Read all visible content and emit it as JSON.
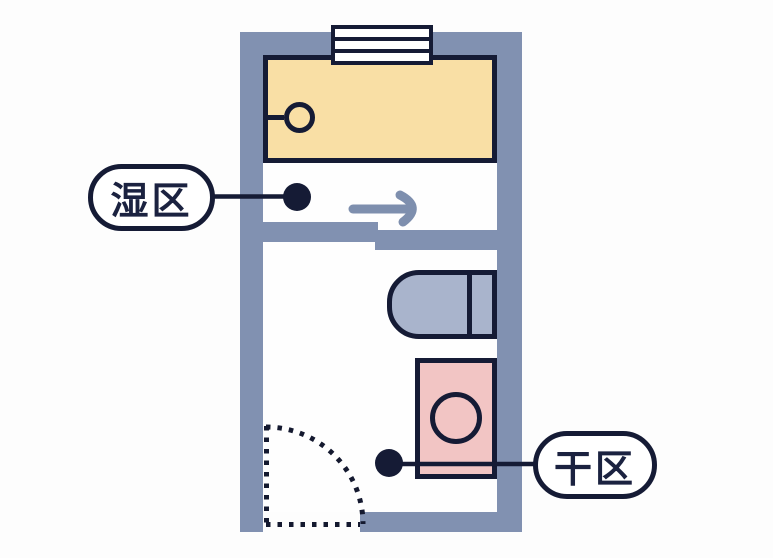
{
  "zones": [
    {
      "id": "wet-zone",
      "label": "湿区"
    },
    {
      "id": "dry-zone",
      "label": "干区"
    }
  ],
  "fixtures": [
    {
      "name": "window",
      "stripes": 3
    },
    {
      "name": "bathtub"
    },
    {
      "name": "faucet"
    },
    {
      "name": "flow-arrow",
      "direction": "right"
    },
    {
      "name": "partition-wall",
      "segments": 2
    },
    {
      "name": "toilet"
    },
    {
      "name": "washing-machine"
    },
    {
      "name": "door-swing",
      "style": "dotted"
    }
  ],
  "colors": {
    "wall": "#8191B1",
    "bathtub_fill": "#F9DFA5",
    "toilet_fill": "#A9B4CC",
    "washer_fill": "#F2C5C4",
    "outline": "#151B35",
    "arrow": "#7E8FAE",
    "background": "#FDFDFD"
  }
}
